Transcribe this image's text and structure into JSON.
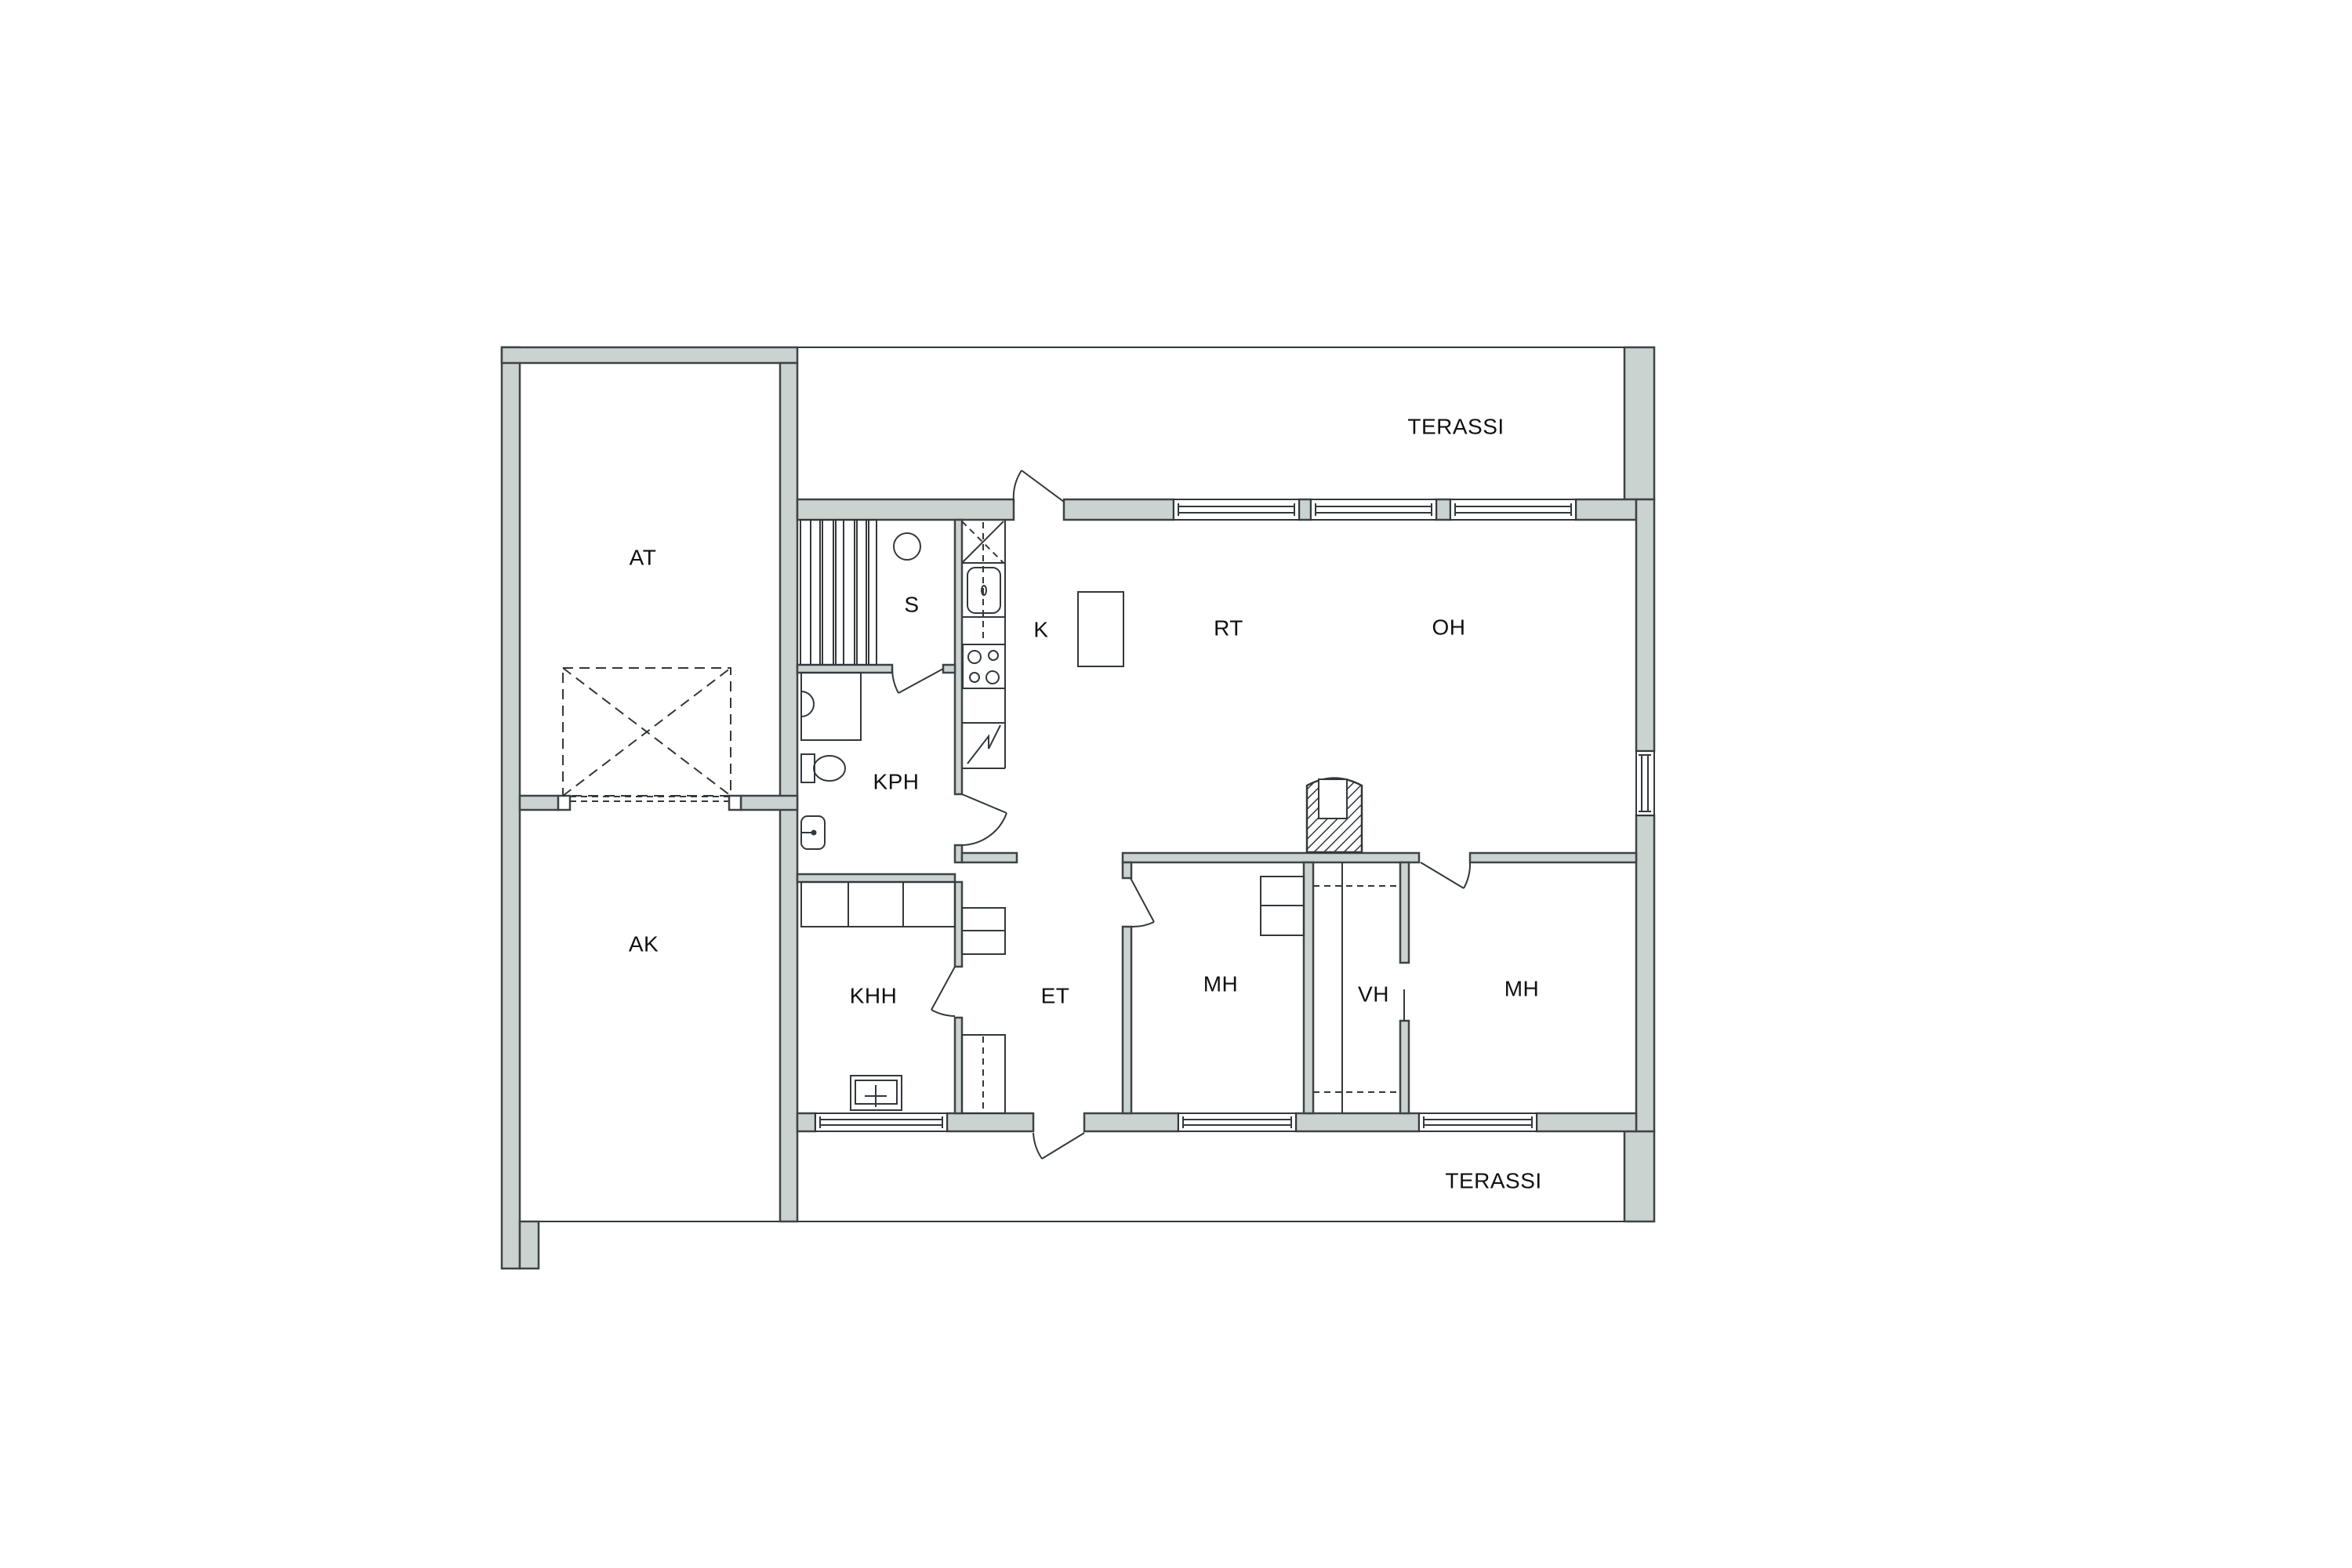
{
  "document": {
    "type": "floor-plan",
    "language": "Finnish"
  },
  "colors": {
    "wall_fill": "#cbd3d0",
    "outline": "#3e4347",
    "thin_line": "#33383c",
    "label_text": "#111111",
    "background": "#ffffff"
  },
  "labels": {
    "at": "AT",
    "ak": "AK",
    "sauna": "S",
    "kph": "KPH",
    "khh": "KHH",
    "kitchen": "K",
    "rt": "RT",
    "oh": "OH",
    "et": "ET",
    "mh_left": "MH",
    "vh": "VH",
    "mh_right": "MH",
    "terrace_top": "TERASSI",
    "terrace_bottom": "TERASSI"
  }
}
